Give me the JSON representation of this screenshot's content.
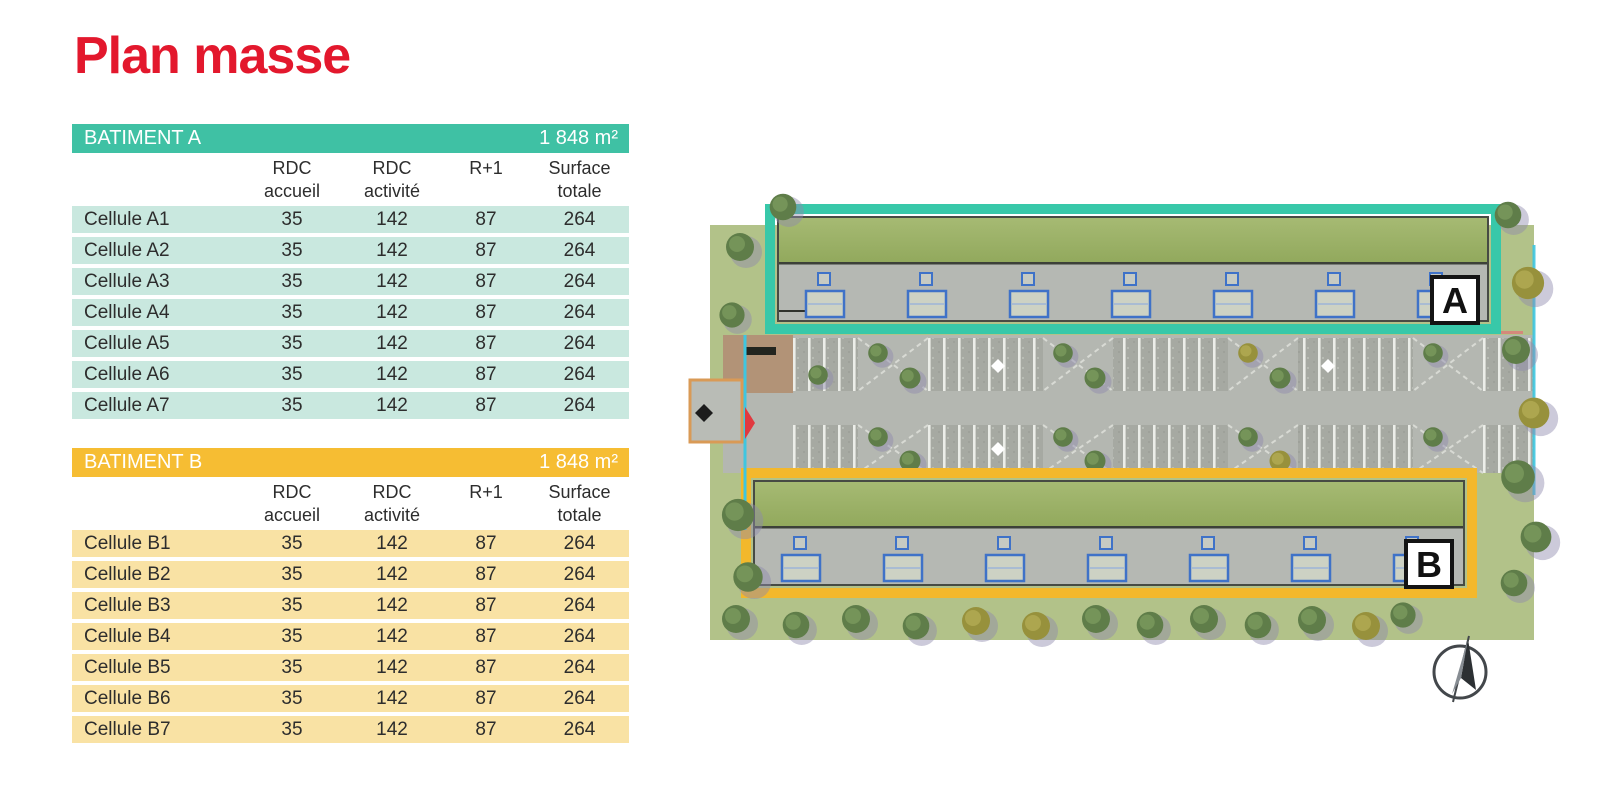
{
  "page": {
    "title": "Plan masse"
  },
  "colors": {
    "title_red": "#e3182d",
    "batiment_a_header_bg": "#3fc1a4",
    "batiment_a_row_bg": "#c9e8df",
    "batiment_b_header_bg": "#f6bd33",
    "batiment_b_row_bg": "#f9e2a4",
    "building_a_outline": "#38c8a9",
    "building_b_outline": "#f3b82c",
    "roof_green": "#9db368",
    "concrete_gray": "#b5b8b3",
    "grass_green": "#b2c289",
    "door_blue": "#3f72c8"
  },
  "tables": [
    {
      "id": "batiment-a",
      "header": {
        "label": "BATIMENT A",
        "area": "1 848 m²"
      },
      "columns": [
        {
          "line1": "",
          "line2": ""
        },
        {
          "line1": "RDC",
          "line2": "accueil"
        },
        {
          "line1": "RDC",
          "line2": "activité"
        },
        {
          "line1": "R+1",
          "line2": ""
        },
        {
          "line1": "Surface",
          "line2": "totale"
        }
      ],
      "rows": [
        {
          "label": "Cellule A1",
          "values": [
            "35",
            "142",
            "87",
            "264"
          ]
        },
        {
          "label": "Cellule A2",
          "values": [
            "35",
            "142",
            "87",
            "264"
          ]
        },
        {
          "label": "Cellule A3",
          "values": [
            "35",
            "142",
            "87",
            "264"
          ]
        },
        {
          "label": "Cellule A4",
          "values": [
            "35",
            "142",
            "87",
            "264"
          ]
        },
        {
          "label": "Cellule A5",
          "values": [
            "35",
            "142",
            "87",
            "264"
          ]
        },
        {
          "label": "Cellule A6",
          "values": [
            "35",
            "142",
            "87",
            "264"
          ]
        },
        {
          "label": "Cellule A7",
          "values": [
            "35",
            "142",
            "87",
            "264"
          ]
        }
      ]
    },
    {
      "id": "batiment-b",
      "header": {
        "label": "BATIMENT B",
        "area": "1 848 m²"
      },
      "columns": [
        {
          "line1": "",
          "line2": ""
        },
        {
          "line1": "RDC",
          "line2": "accueil"
        },
        {
          "line1": "RDC",
          "line2": "activité"
        },
        {
          "line1": "R+1",
          "line2": ""
        },
        {
          "line1": "Surface",
          "line2": "totale"
        }
      ],
      "rows": [
        {
          "label": "Cellule B1",
          "values": [
            "35",
            "142",
            "87",
            "264"
          ]
        },
        {
          "label": "Cellule B2",
          "values": [
            "35",
            "142",
            "87",
            "264"
          ]
        },
        {
          "label": "Cellule B3",
          "values": [
            "35",
            "142",
            "87",
            "264"
          ]
        },
        {
          "label": "Cellule B4",
          "values": [
            "35",
            "142",
            "87",
            "264"
          ]
        },
        {
          "label": "Cellule B5",
          "values": [
            "35",
            "142",
            "87",
            "264"
          ]
        },
        {
          "label": "Cellule B6",
          "values": [
            "35",
            "142",
            "87",
            "264"
          ]
        },
        {
          "label": "Cellule B7",
          "values": [
            "35",
            "142",
            "87",
            "264"
          ]
        }
      ]
    }
  ],
  "site_plan": {
    "building_a": {
      "label": "A"
    },
    "building_b": {
      "label": "B"
    },
    "compass": {
      "icon": "north-arrow"
    }
  }
}
